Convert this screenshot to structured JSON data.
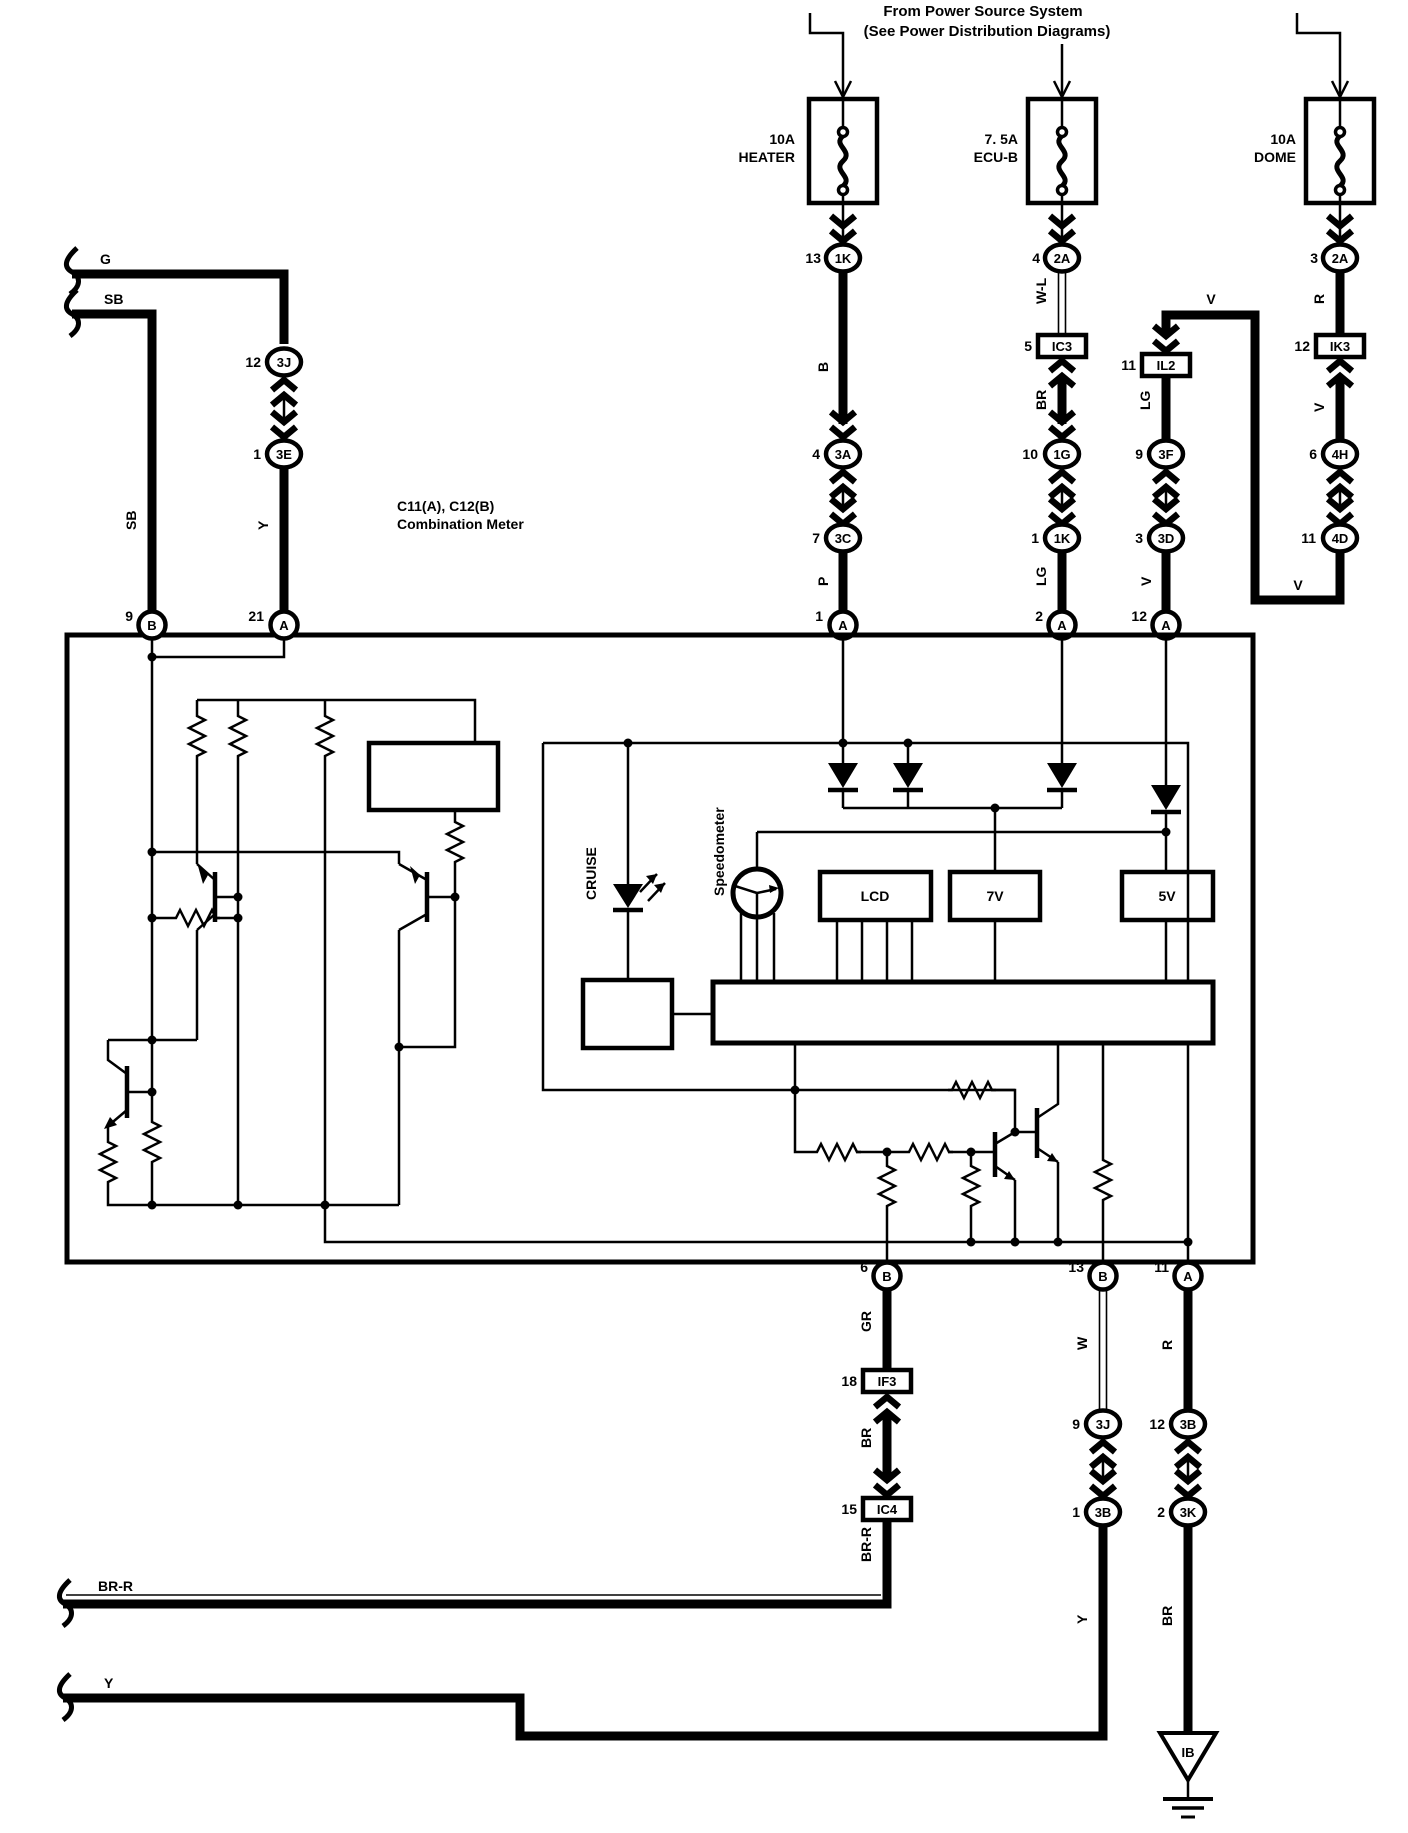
{
  "colors": {
    "ink": "#000000",
    "paper": "#ffffff"
  },
  "header": {
    "line1": "From Power Source System",
    "line2": "(See Power Distribution Diagrams)"
  },
  "fuses": {
    "heater": {
      "rating": "10A",
      "name": "HEATER"
    },
    "ecub": {
      "rating": "7. 5A",
      "name": "ECU-B"
    },
    "dome": {
      "rating": "10A",
      "name": "DOME"
    }
  },
  "meter": {
    "code": "C11(A), C12(B)",
    "name": "Combination Meter"
  },
  "parts": {
    "cruise": "CRUISE",
    "speedometer": "Speedometer",
    "lcd": "LCD",
    "v7": "7V",
    "v5": "5V",
    "ib": "IB"
  },
  "connectors": {
    "c13_1k": {
      "pin": "13",
      "code": "1K"
    },
    "c4_3a": {
      "pin": "4",
      "code": "3A"
    },
    "c7_3c": {
      "pin": "7",
      "code": "3C"
    },
    "c1_a": {
      "pin": "1",
      "code": "A"
    },
    "c4_2a": {
      "pin": "4",
      "code": "2A"
    },
    "c5_ic3": {
      "pin": "5",
      "code": "IC3"
    },
    "c10_1g": {
      "pin": "10",
      "code": "1G"
    },
    "c1_1k": {
      "pin": "1",
      "code": "1K"
    },
    "c2_a": {
      "pin": "2",
      "code": "A"
    },
    "c11_il2": {
      "pin": "11",
      "code": "IL2"
    },
    "c9_3f": {
      "pin": "9",
      "code": "3F"
    },
    "c3_3d": {
      "pin": "3",
      "code": "3D"
    },
    "c12_a": {
      "pin": "12",
      "code": "A"
    },
    "c3_2a": {
      "pin": "3",
      "code": "2A"
    },
    "c12_ik3": {
      "pin": "12",
      "code": "IK3"
    },
    "c6_4h": {
      "pin": "6",
      "code": "4H"
    },
    "c11_4d": {
      "pin": "11",
      "code": "4D"
    },
    "c12_3j": {
      "pin": "12",
      "code": "3J"
    },
    "c1_3e": {
      "pin": "1",
      "code": "3E"
    },
    "c21_a": {
      "pin": "21",
      "code": "A"
    },
    "c9_b": {
      "pin": "9",
      "code": "B"
    },
    "c6_b": {
      "pin": "6",
      "code": "B"
    },
    "c13_b": {
      "pin": "13",
      "code": "B"
    },
    "c11_a": {
      "pin": "11",
      "code": "A"
    },
    "c18_if3": {
      "pin": "18",
      "code": "IF3"
    },
    "c15_ic4": {
      "pin": "15",
      "code": "IC4"
    },
    "c9_3j": {
      "pin": "9",
      "code": "3J"
    },
    "c1_3b": {
      "pin": "1",
      "code": "3B"
    },
    "c12_3b": {
      "pin": "12",
      "code": "3B"
    },
    "c2_3k": {
      "pin": "2",
      "code": "3K"
    }
  },
  "wires": {
    "g": "G",
    "sb_h": "SB",
    "sb_v": "SB",
    "y_left": "Y",
    "b": "B",
    "p": "P",
    "wl": "W-L",
    "br_ecu": "BR",
    "lg_ecu": "LG",
    "lg_il2": "LG",
    "v_top": "V",
    "v_il2": "V",
    "r_dome": "R",
    "v_dome": "V",
    "v_4d": "V",
    "gr": "GR",
    "br_mid": "BR",
    "brr_v": "BR-R",
    "brr_h": "BR-R",
    "w": "W",
    "y_3b": "Y",
    "y_bot": "Y",
    "r_11a": "R",
    "br_3k": "BR"
  }
}
